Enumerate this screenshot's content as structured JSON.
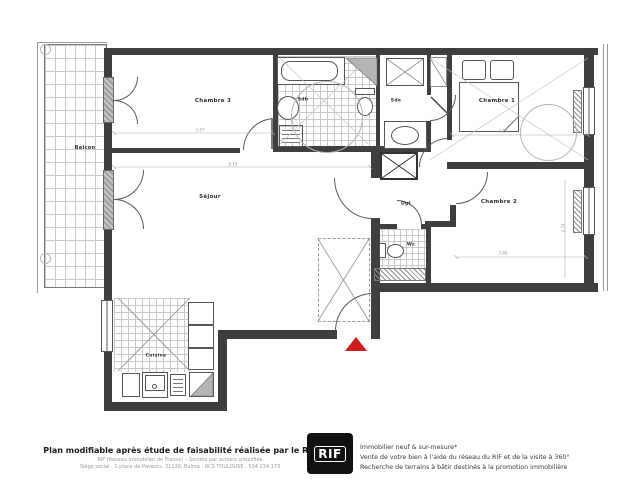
{
  "plan": {
    "rooms": {
      "balcon": "Balcon",
      "chambre3": "Chambre 3",
      "sdb": "Sdb",
      "sde": "Sde",
      "chambre1": "Chambre 1",
      "sejour": "Séjour",
      "dgt": "Dgt",
      "chambre2": "Chambre 2",
      "wc": "Wc",
      "cuisine": "Cuisine"
    },
    "dimensions": {
      "chambre3_width": "3.67",
      "sejour_width": "6.19",
      "chambre1_width": "4.17",
      "chambre2_width": "3.60",
      "chambre2_height": "2.74"
    },
    "colors": {
      "wall": "#3f3f3f",
      "entrance_marker": "#cf1b1b"
    }
  },
  "footer": {
    "left_title": "Plan modifiable après étude de faisabilité réalisée par le RIF",
    "left_line1": "RIF (Réseau Immobilier de France) – Société par actions simplifiée",
    "left_line2": "Siège social : 1 place de Paveurs, 31130, Balma - RCS TOULOUSE : 534 234 173",
    "logo_text": "RIF",
    "right_line1": "Immobilier neuf & sur-mesure*",
    "right_line2": "Vente de votre bien à l'aide du réseau du RIF et de la visite à 360°",
    "right_line3": "Recherche de terrains à bâtir destinés à la promotion immobilière"
  }
}
